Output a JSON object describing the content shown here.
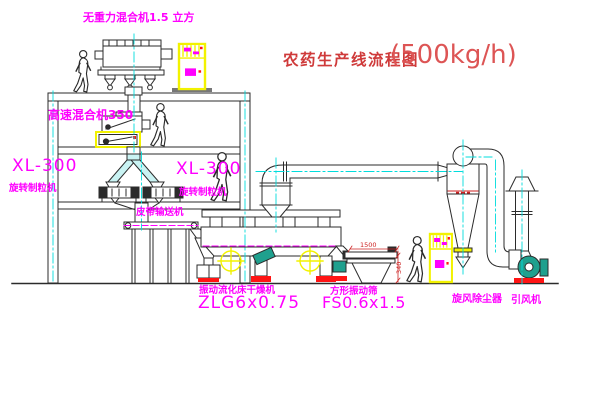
{
  "diagram": {
    "title": {
      "text": "农药生产线流程图",
      "capacity": "(500kg/h)"
    },
    "labels": {
      "gravity_mixer": "无重力混合机1.5 立方",
      "high_speed_mixer": "高速混合机350",
      "granulator_left_model": "XL-300",
      "granulator_left_name": "旋转制粒机",
      "granulator_right_model": "XL-300",
      "granulator_right_name": "旋转制粒机",
      "belt_conveyor": "皮带输送机",
      "dryer_name": "振动流化床干燥机",
      "dryer_model": "ZLG6x0.75",
      "screen_name": "方形振动筛",
      "screen_model": "FS0.6x1.5",
      "cyclone": "旋风除尘器",
      "induced_draft_fan": "引风机"
    },
    "dimensions": {
      "screen_length": "1500",
      "screen_height": "340"
    },
    "colors": {
      "line": "#2b2b2b",
      "centerline_cyan": "#00dcdc",
      "label_magenta": "#ff00ff",
      "title_red": "#cf3a3a",
      "highlight_yellow": "#f2f200",
      "machine_green": "#1fa08e",
      "accent_red": "#ff1414"
    }
  }
}
